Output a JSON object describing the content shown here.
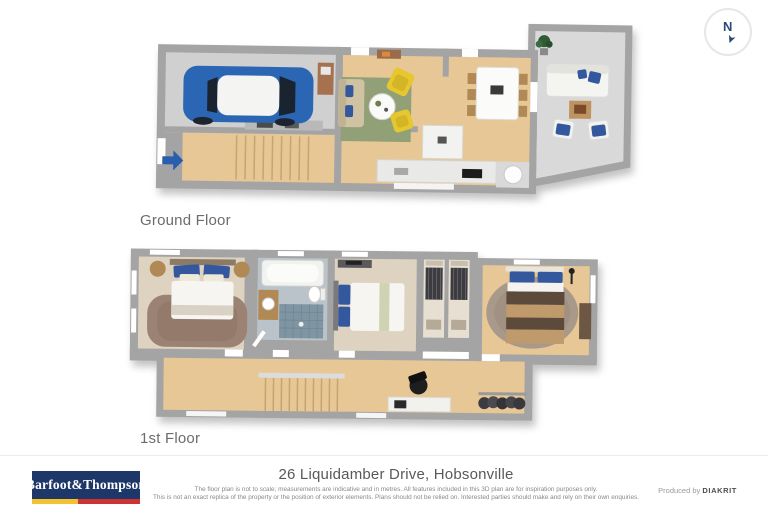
{
  "compass": {
    "label": "N"
  },
  "floors": {
    "ground": {
      "label": "Ground Floor"
    },
    "first": {
      "label": "1st Floor"
    }
  },
  "footer": {
    "logo_text": "Barfoot&Thompson",
    "address": "26 Liquidamber Drive, Hobsonville",
    "disclaimer_line1": "The floor plan is not to scale; measurements are indicative and in metres. All features included in this 3D plan are for inspiration purposes only.",
    "disclaimer_line2": "This is not an exact replica of the property or the position of exterior elements. Plans should not be relied on. Interested parties should make and rely on their own enquiries.",
    "produced_by": "Produced by",
    "producer": "DIAKRIT"
  },
  "colors": {
    "brand_navy": "#1d3868",
    "brand_yellow": "#f2c230",
    "brand_red": "#cc3333",
    "compass_navy": "#2b4a73",
    "entry_arrow_blue": "#2b5dad",
    "car_blue": "#2b66b5",
    "wall_gray": "#a4a4a4",
    "wood_floor": "#e7c795",
    "concrete_floor": "#d0d0d0",
    "patio_floor": "#d9d9d9",
    "rug_green": "#91a077",
    "chair_yellow": "#e6c730",
    "cushion_blue": "#33589e",
    "carpet_beige": "#ded2c0",
    "rug_mauve": "#9b8273",
    "rug_taupe": "#a8998b",
    "tile_blue": "#7f95a2",
    "bed_brown_dark": "#5c4a3a",
    "bed_brown_light": "#c09a6a"
  }
}
